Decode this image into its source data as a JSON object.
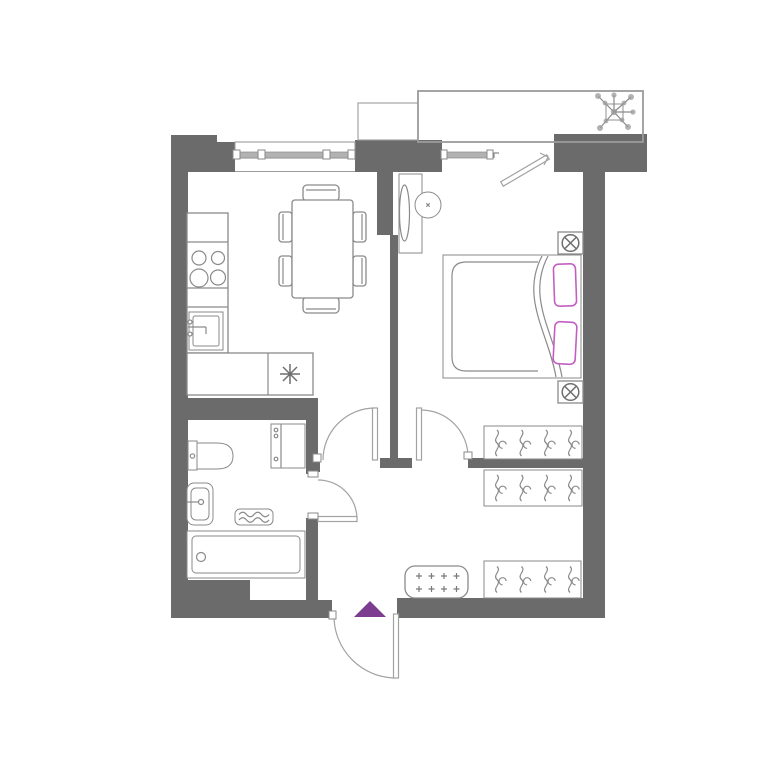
{
  "document": {
    "kind": "apartment-floor-plan",
    "view": "top-down architectural drawing",
    "visible_text": "none"
  },
  "palette": {
    "background": "#ffffff",
    "wall": "#6b6b6b",
    "outline": "#8a8a8a",
    "outline_light": "#a2a2a2",
    "glass": "#b2b2b2",
    "accent_pillow": "#c35fc3",
    "accent_entrance": "#7c3d90"
  },
  "legend": {
    "entrance_marker": "purple triangle at entry door",
    "rooms": [
      {
        "name": "kitchen-living-room",
        "furniture": [
          "kitchen-counter",
          "stove",
          "kitchen-sink",
          "dining-table",
          "chairs",
          "asterisk-appliance"
        ]
      },
      {
        "name": "bedroom",
        "furniture": [
          "double-bed",
          "pillows",
          "duvet",
          "dressing-table-with-mirror",
          "stool",
          "bedside-spotlights",
          "wardrobe"
        ]
      },
      {
        "name": "bathroom",
        "furniture": [
          "toilet",
          "washbasin",
          "bathtub",
          "washing-machine",
          "towel-radiator"
        ]
      },
      {
        "name": "hallway",
        "furniture": [
          "wardrobes",
          "shoe-bench"
        ]
      },
      {
        "name": "balcony",
        "furniture": [
          "plant"
        ]
      }
    ],
    "counts": {
      "wardrobe_units": 3,
      "hangers_per_wardrobe": 4,
      "stove_burners": 4,
      "dining_chairs": 6,
      "bed_pillows": 2,
      "bench_dots": 8,
      "spotlight_symbols": 2,
      "interior_door_arcs": 4,
      "windows": 2
    }
  }
}
